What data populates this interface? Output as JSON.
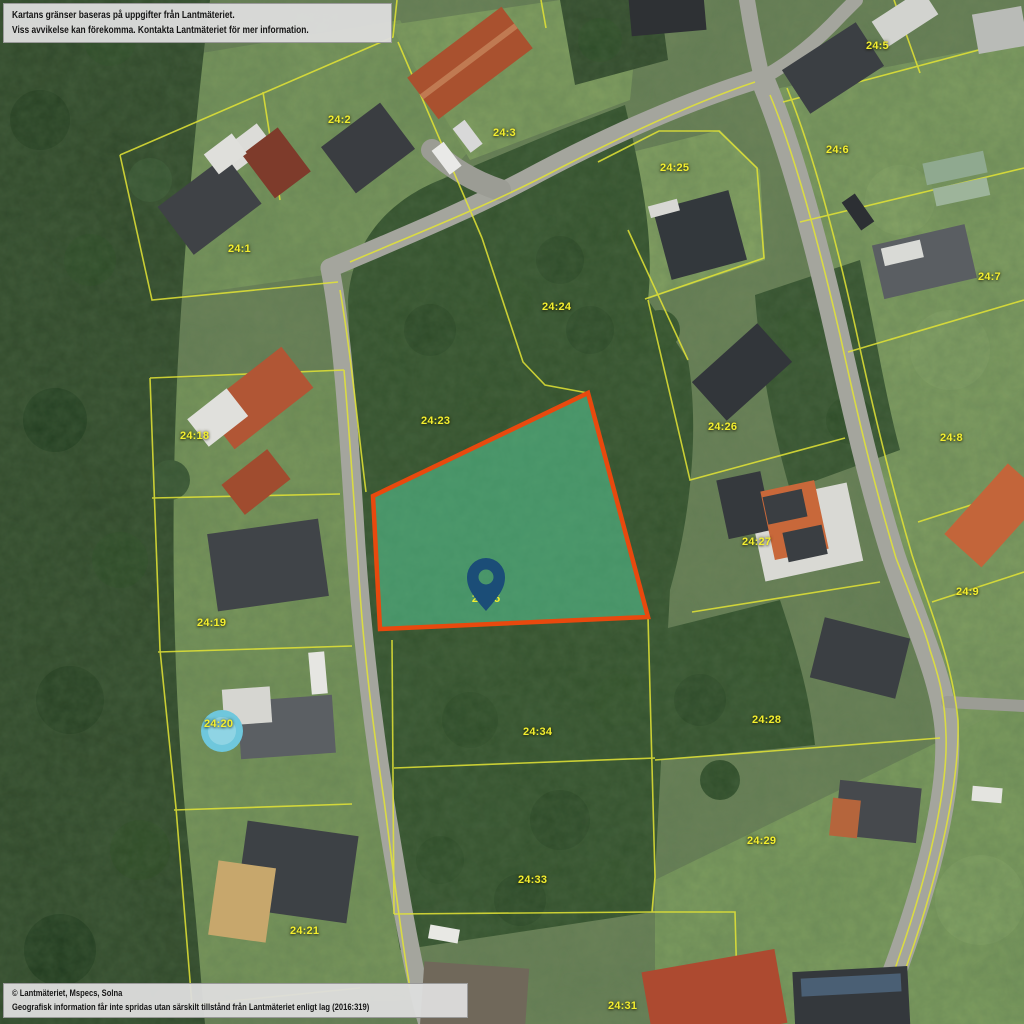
{
  "map": {
    "disclaimer_box": {
      "line1": "Kartans gränser baseras på uppgifter från Lantmäteriet.",
      "line2": "Viss avvikelse kan förekomma. Kontakta Lantmäteriet för mer information."
    },
    "attribution_box": {
      "line1": "© Lantmäteriet, Mspecs, Solna",
      "line2": "Geografisk information får inte spridas utan särskilt tillstånd från Lantmäteriet enligt lag (2016:319)"
    },
    "parcel_labels": [
      {
        "id": "24:1",
        "x": 228,
        "y": 243
      },
      {
        "id": "24:2",
        "x": 328,
        "y": 114
      },
      {
        "id": "24:3",
        "x": 493,
        "y": 127
      },
      {
        "id": "24:5",
        "x": 866,
        "y": 40
      },
      {
        "id": "24:6",
        "x": 826,
        "y": 144
      },
      {
        "id": "24:7",
        "x": 978,
        "y": 271
      },
      {
        "id": "24:8",
        "x": 940,
        "y": 432
      },
      {
        "id": "24:9",
        "x": 956,
        "y": 586
      },
      {
        "id": "24:18",
        "x": 180,
        "y": 430
      },
      {
        "id": "24:19",
        "x": 197,
        "y": 617
      },
      {
        "id": "24:20",
        "x": 204,
        "y": 718
      },
      {
        "id": "24:21",
        "x": 290,
        "y": 925
      },
      {
        "id": "24:23",
        "x": 421,
        "y": 415
      },
      {
        "id": "24:24",
        "x": 542,
        "y": 301
      },
      {
        "id": "24:25",
        "x": 660,
        "y": 162
      },
      {
        "id": "24:26",
        "x": 708,
        "y": 421
      },
      {
        "id": "24:27",
        "x": 742,
        "y": 536
      },
      {
        "id": "24:28",
        "x": 752,
        "y": 714
      },
      {
        "id": "24:29",
        "x": 747,
        "y": 835
      },
      {
        "id": "24:31",
        "x": 608,
        "y": 1000
      },
      {
        "id": "24:33",
        "x": 518,
        "y": 874
      },
      {
        "id": "24:34",
        "x": 523,
        "y": 726
      }
    ],
    "highlighted_parcel": {
      "label": "24:35",
      "fill_color": "#55c896",
      "fill_opacity": "0.55",
      "border_color": "#e8490e"
    },
    "marker": {
      "color": "#1b4d77"
    },
    "colors": {
      "boundary_line": "#e3e435",
      "label_text": "#f3ee2f"
    }
  }
}
